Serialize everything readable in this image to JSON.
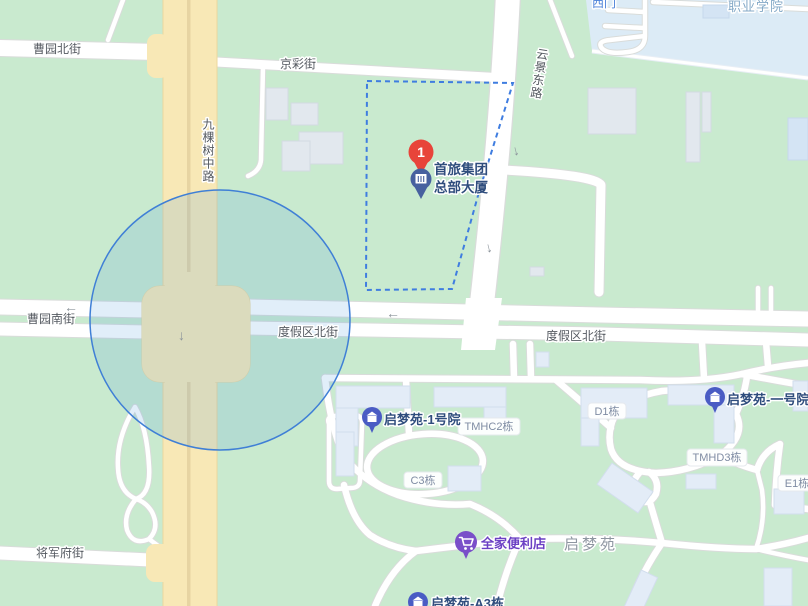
{
  "map_type": "web-map-viewport",
  "streets": {
    "caoyuan_north": "曹园北街",
    "jingcai": "京彩街",
    "jiukeshu_middle": "九棵树中路",
    "yunjing_east": "云景东路",
    "caoyuan_south": "曹园南街",
    "dujiaqu_north_1": "度假区北街",
    "dujiaqu_north_2": "度假区北街",
    "jiangjunfu": "将军府街"
  },
  "areas": {
    "vocational_college": "职业学院",
    "west_gate": "西门",
    "qimengyuan_compound": "启梦苑"
  },
  "pois": {
    "shoulv": {
      "rank": "1",
      "name_line1": "首旅集团",
      "name_line2": "总部大厦"
    },
    "yard1": "启梦苑-1号院",
    "yard1_alt": "启梦苑-一号院",
    "familymart": "全家便利店",
    "a3": "启梦苑-A3栋"
  },
  "badges": {
    "tmhc2": "TMHC2栋",
    "d1": "D1栋",
    "tmhd3": "TMHD3栋",
    "c3": "C3栋",
    "e1": "E1栋"
  },
  "colors": {
    "land": "#c9eacf",
    "campus": "#dcebf6",
    "main_road": "#f8e8b6",
    "selection_circle": "#3f7fd6",
    "parcel_boundary": "#3f7de0",
    "marker_red": "#e8443a",
    "marker_blue": "#47619f",
    "poi_indigo": "#4a5cc4",
    "familymart_purple": "#7a4fc9"
  }
}
